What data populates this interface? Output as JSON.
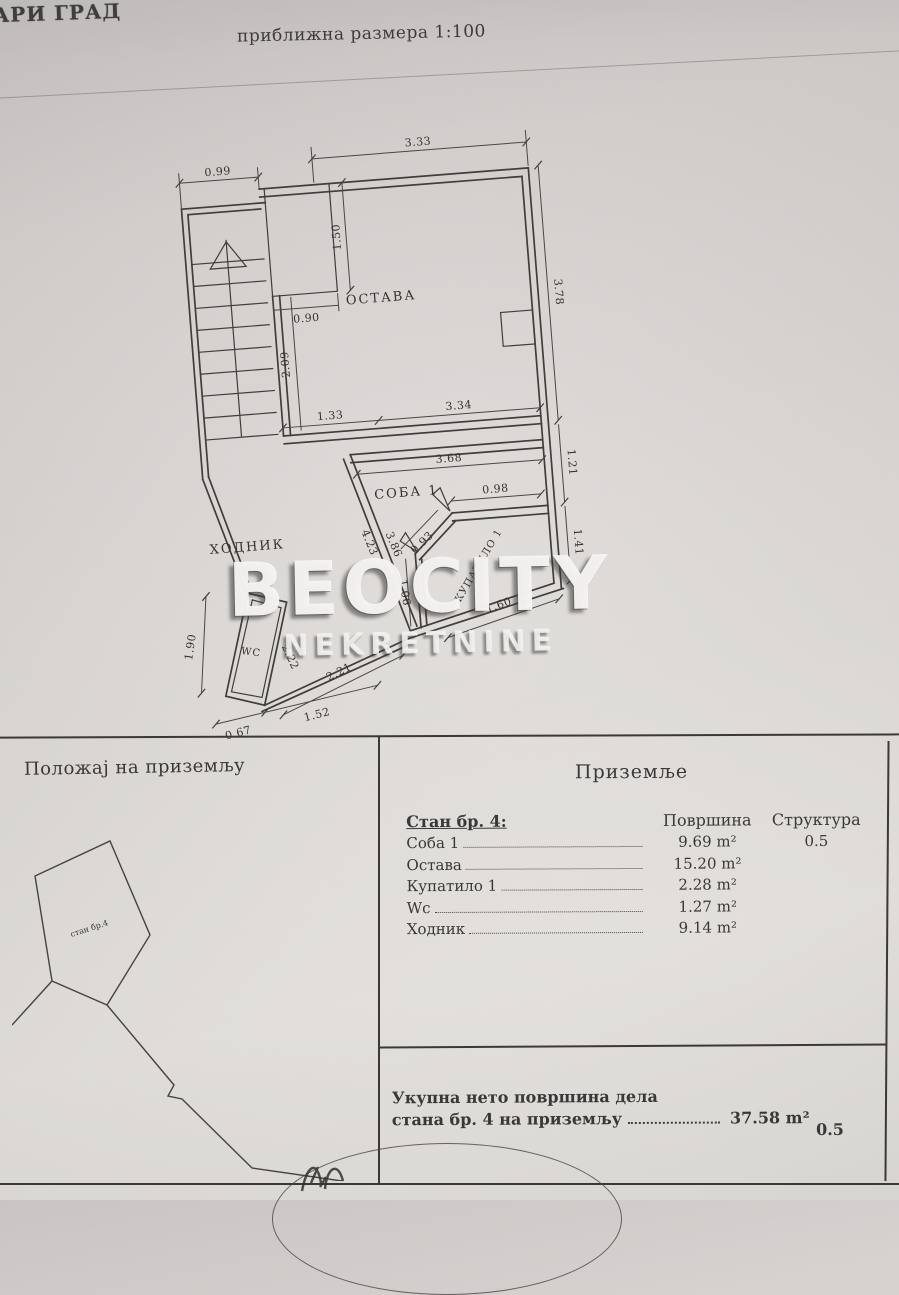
{
  "page": {
    "header_left": "АРИ ГРАД",
    "scale_note": "приближна размера 1:100"
  },
  "watermark": {
    "line1": "BEOCITY",
    "line2": "NEKRETNINE"
  },
  "plan": {
    "rooms": {
      "storage": "ОСТАВА",
      "room1": "СОБА 1",
      "hall": "ХОДНИК",
      "wc": "WC",
      "bath": "КУПАТИЛО 1"
    },
    "dims": {
      "w099": "0.99",
      "w333": "3.33",
      "w150": "1.50",
      "w090": "0.90",
      "w378": "3.78",
      "w209": "2.09",
      "w133": "1.33",
      "w334": "3.34",
      "w368": "3.68",
      "w121": "1.21",
      "w098": "0.98",
      "w093": "0.93",
      "w141": "1.41",
      "w106": "1.06",
      "w160": "1.60",
      "w221": "2.21",
      "w423": "4.23",
      "w386": "3.86",
      "w222": "2.22",
      "w190": "1.90",
      "w067": "0.67",
      "w152": "1.52"
    }
  },
  "site_sketch": {
    "unit_label": "стан бр.4"
  },
  "table": {
    "left_title": "Положај на приземљу",
    "right_title": "Приземље",
    "unit_title": "Стан бр. 4:",
    "col_area": "Површина",
    "col_structure": "Структура",
    "rows": [
      {
        "name": "Соба 1",
        "area": "9.69 m²",
        "structure": "0.5"
      },
      {
        "name": "Остава",
        "area": "15.20 m²"
      },
      {
        "name": "Купатило 1",
        "area": "2.28 m²"
      },
      {
        "name": "Wc",
        "area": "1.27 m²"
      },
      {
        "name": "Ходник",
        "area": "9.14 m²"
      }
    ],
    "total": {
      "line1": "Укупна нето површина дела",
      "line2": "стана бр. 4 на приземљу",
      "area": "37.58 m²",
      "structure": "0.5"
    }
  },
  "colors": {
    "paper": "#d8d4d2",
    "ink": "#3b3835"
  }
}
